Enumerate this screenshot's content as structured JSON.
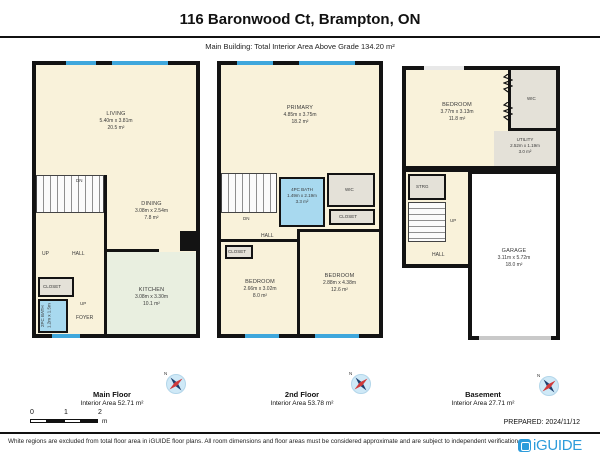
{
  "header": {
    "title": "116 Baronwood Ct, Brampton, ON",
    "subtitle": "Main Building: Total Interior Area Above Grade 134.20 m²"
  },
  "floors": {
    "main": {
      "label": "Main Floor",
      "area_label": "Interior Area 52.71 m²",
      "rooms": {
        "living": {
          "name": "LIVING",
          "dims": "5.40m x 3.81m",
          "area": "20.5 m²"
        },
        "dining": {
          "name": "DINING",
          "dims": "3.08m x 2.54m",
          "area": "7.8 m²"
        },
        "kitchen": {
          "name": "KITCHEN",
          "dims": "3.08m x 3.30m",
          "area": "10.1 m²"
        },
        "bath": {
          "name": "2PC BATH",
          "dims": "1.2m x 1.5m"
        },
        "closet": "CLOSET",
        "hall": "HALL",
        "foyer": "FOYER",
        "up": "UP",
        "dn": "DN"
      }
    },
    "second": {
      "label": "2nd Floor",
      "area_label": "Interior Area 53.78 m²",
      "rooms": {
        "primary": {
          "name": "PRIMARY",
          "dims": "4.85m x 3.75m",
          "area": "18.2 m²"
        },
        "bath": {
          "name": "4PC BATH",
          "dims": "1.49m x 2.19m",
          "area": "3.3 m²"
        },
        "wic": "WIC",
        "closet": "CLOSET",
        "closet2": "CLOSET",
        "hall": "HALL",
        "dn": "DN",
        "bedroom1": {
          "name": "BEDROOM",
          "dims": "2.66m x 3.02m",
          "area": "8.0 m²"
        },
        "bedroom2": {
          "name": "BEDROOM",
          "dims": "2.88m x 4.38m",
          "area": "12.6 m²"
        }
      }
    },
    "basement": {
      "label": "Basement",
      "area_label": "Interior Area 27.71 m²",
      "rooms": {
        "bedroom": {
          "name": "BEDROOM",
          "dims": "3.77m x 3.13m",
          "area": "11.8 m²"
        },
        "wic": "WIC",
        "utility": {
          "name": "UTILITY",
          "dims": "2.52m x 1.19m",
          "area": "3.0 m²"
        },
        "strg": "STRG",
        "hall": "HALL",
        "up": "UP",
        "garage": {
          "name": "GARAGE",
          "dims": "3.11m x 5.72m",
          "area": "18.0 m²"
        }
      }
    }
  },
  "compass": {
    "north": "N"
  },
  "scale": {
    "ticks": [
      "0",
      "1",
      "2"
    ],
    "unit": "m"
  },
  "footer": {
    "prepared": "PREPARED: 2024/11/12",
    "brand": "iGUIDE",
    "disclaimer": "White regions are excluded from total floor area in iGUIDE floor plans. All room dimensions and floor areas must be considered approximate and are subject to independent verification."
  },
  "colors": {
    "wall": "#131313",
    "floor_cream": "#f9f2da",
    "kitchen_green": "#e9efe0",
    "bath_blue": "#a8d9ef",
    "closet_grey": "#e4e1d8",
    "window_blue": "#3fa7dc",
    "brand_blue": "#2d9cdb",
    "compass_fill": "#cfe9f7"
  }
}
